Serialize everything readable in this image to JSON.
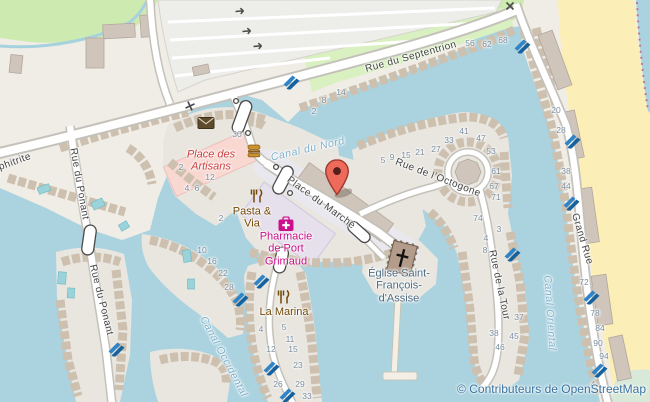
{
  "attribution": {
    "text": "© Contributeurs de OpenStreetMap"
  },
  "marker": {
    "label": "Place du Marché",
    "x": 337,
    "y": 197
  },
  "colors": {
    "water": "#abd3df",
    "land": "#f0ede6",
    "island": "#e9e6e0",
    "beach": "#fbeeb7",
    "park": "#cdebb0",
    "parking": "#ededea",
    "casing": "#c4c1ba",
    "road": "#ffffff",
    "buildingLine": "#cdc0af",
    "bigBuilding": "#cfc5bb",
    "retailPink": "#fad8d2",
    "plazaLavender": "#e6e0ec",
    "pier": "#f3efe4",
    "pool": "#9ad4da",
    "slipway": "#1f6fb3",
    "markerRed": "#ee6a5a",
    "streetText": "#444444",
    "waterText": "#7fb0cc",
    "numberText": "#7b8fa0",
    "poiBrown": "#734a08",
    "poiMagenta": "#cc0f8a",
    "poiRed": "#cc3e3e",
    "churchText": "#4e6c80",
    "attribution": "#39739f"
  },
  "street_labels": [
    {
      "text": "Rue du Septentrion",
      "x": 411,
      "y": 57,
      "rot": -15.5
    },
    {
      "text": "Grand Rue",
      "x": 582,
      "y": 239,
      "rot": 73
    },
    {
      "text": "Rue du Ponant",
      "x": 79,
      "y": 184,
      "rot": 80
    },
    {
      "text": "Rue du Ponant",
      "x": 101,
      "y": 300,
      "rot": 76
    },
    {
      "text": "Rue de l’Octogone",
      "x": 438,
      "y": 178,
      "rot": 21
    },
    {
      "text": "Rue de la Tour",
      "x": 499,
      "y": 285,
      "rot": 78
    },
    {
      "text": "Place du Marché",
      "x": 321,
      "y": 203,
      "rot": 36
    },
    {
      "text": "phitrite",
      "x": 15,
      "y": 162,
      "rot": -20
    }
  ],
  "water_labels": [
    {
      "text": "Canal du Nord",
      "x": 308,
      "y": 150,
      "rot": -13
    },
    {
      "text": "Canal Occidental",
      "x": 223,
      "y": 357,
      "rot": 62
    },
    {
      "text": "Canal Oriental",
      "x": 549,
      "y": 313,
      "rot": 86
    }
  ],
  "poi_labels": [
    {
      "text": "Place des\nArtisans",
      "x": 211,
      "y": 161,
      "rot": 0,
      "color": "#cc3e3e",
      "italic": true
    },
    {
      "text": "Pasta &\nVia",
      "x": 252,
      "y": 218,
      "color": "#734a08"
    },
    {
      "text": "Pharmacie\nde Port\nGrimaud",
      "x": 286,
      "y": 249,
      "color": "#cc0f8a"
    },
    {
      "text": "La Marina",
      "x": 284,
      "y": 312,
      "color": "#734a08"
    },
    {
      "text": "Église Saint-\nFrançois-\nd'Assise",
      "x": 399,
      "y": 286,
      "color": "#4e6c80"
    }
  ],
  "house_numbers": [
    {
      "t": "2",
      "x": 314,
      "y": 112
    },
    {
      "t": "8",
      "x": 324,
      "y": 101
    },
    {
      "t": "14",
      "x": 341,
      "y": 93
    },
    {
      "t": "56",
      "x": 470,
      "y": 44
    },
    {
      "t": "62",
      "x": 487,
      "y": 45
    },
    {
      "t": "68",
      "x": 503,
      "y": 41
    },
    {
      "t": "30",
      "x": 237,
      "y": 135
    },
    {
      "t": "2",
      "x": 181,
      "y": 168
    },
    {
      "t": "12",
      "x": 210,
      "y": 178
    },
    {
      "t": "4",
      "x": 187,
      "y": 189
    },
    {
      "t": "6",
      "x": 197,
      "y": 189
    },
    {
      "t": "5",
      "x": 383,
      "y": 161
    },
    {
      "t": "9",
      "x": 392,
      "y": 158
    },
    {
      "t": "15",
      "x": 406,
      "y": 156
    },
    {
      "t": "21",
      "x": 420,
      "y": 153
    },
    {
      "t": "27",
      "x": 436,
      "y": 150
    },
    {
      "t": "33",
      "x": 449,
      "y": 141
    },
    {
      "t": "41",
      "x": 464,
      "y": 132
    },
    {
      "t": "47",
      "x": 481,
      "y": 139
    },
    {
      "t": "53",
      "x": 491,
      "y": 152
    },
    {
      "t": "61",
      "x": 496,
      "y": 172
    },
    {
      "t": "67",
      "x": 494,
      "y": 187
    },
    {
      "t": "71",
      "x": 496,
      "y": 198
    },
    {
      "t": "74",
      "x": 478,
      "y": 219
    },
    {
      "t": "3",
      "x": 499,
      "y": 230
    },
    {
      "t": "4",
      "x": 486,
      "y": 239
    },
    {
      "t": "8",
      "x": 485,
      "y": 251
    },
    {
      "t": "20",
      "x": 556,
      "y": 111
    },
    {
      "t": "28",
      "x": 561,
      "y": 131
    },
    {
      "t": "38",
      "x": 566,
      "y": 172
    },
    {
      "t": "44",
      "x": 566,
      "y": 187
    },
    {
      "t": "72",
      "x": 584,
      "y": 283
    },
    {
      "t": "78",
      "x": 595,
      "y": 314
    },
    {
      "t": "84",
      "x": 600,
      "y": 329
    },
    {
      "t": "90",
      "x": 598,
      "y": 344
    },
    {
      "t": "94",
      "x": 604,
      "y": 357
    },
    {
      "t": "4",
      "x": 593,
      "y": 385
    },
    {
      "t": "37",
      "x": 519,
      "y": 318
    },
    {
      "t": "38",
      "x": 494,
      "y": 334
    },
    {
      "t": "45",
      "x": 514,
      "y": 337
    },
    {
      "t": "46",
      "x": 500,
      "y": 348
    },
    {
      "t": "10",
      "x": 202,
      "y": 251
    },
    {
      "t": "16",
      "x": 212,
      "y": 262
    },
    {
      "t": "22",
      "x": 223,
      "y": 274
    },
    {
      "t": "28",
      "x": 229,
      "y": 288
    },
    {
      "t": "2",
      "x": 221,
      "y": 219
    },
    {
      "t": "4",
      "x": 261,
      "y": 330
    },
    {
      "t": "5",
      "x": 284,
      "y": 328
    },
    {
      "t": "11",
      "x": 290,
      "y": 340
    },
    {
      "t": "12",
      "x": 271,
      "y": 350
    },
    {
      "t": "15",
      "x": 293,
      "y": 350
    },
    {
      "t": "23",
      "x": 298,
      "y": 366
    },
    {
      "t": "26",
      "x": 278,
      "y": 385
    },
    {
      "t": "29",
      "x": 300,
      "y": 385
    },
    {
      "t": "33",
      "x": 307,
      "y": 397
    }
  ],
  "icons": [
    {
      "type": "post-icon",
      "x": 206,
      "y": 123
    },
    {
      "type": "fast-food-icon",
      "x": 254,
      "y": 151
    },
    {
      "type": "restaurant-icon",
      "x": 256,
      "y": 196
    },
    {
      "type": "restaurant-icon",
      "x": 283,
      "y": 297
    },
    {
      "type": "pharmacy-icon",
      "x": 286,
      "y": 224
    },
    {
      "type": "slipway-icon",
      "x": 292,
      "y": 82
    },
    {
      "type": "slipway-icon",
      "x": 523,
      "y": 46
    },
    {
      "type": "slipway-icon",
      "x": 262,
      "y": 281
    },
    {
      "type": "slipway-icon",
      "x": 241,
      "y": 299
    },
    {
      "type": "slipway-icon",
      "x": 272,
      "y": 368
    },
    {
      "type": "slipway-icon",
      "x": 288,
      "y": 395
    },
    {
      "type": "slipway-icon",
      "x": 573,
      "y": 141
    },
    {
      "type": "slipway-icon",
      "x": 572,
      "y": 203
    },
    {
      "type": "slipway-icon",
      "x": 513,
      "y": 254
    },
    {
      "type": "slipway-icon",
      "x": 592,
      "y": 297
    },
    {
      "type": "slipway-icon",
      "x": 600,
      "y": 370
    },
    {
      "type": "slipway-icon",
      "x": 117,
      "y": 349
    },
    {
      "type": "gate-icon",
      "x": 190,
      "y": 106,
      "rot": 20
    },
    {
      "type": "gate-icon",
      "x": 510,
      "y": 6
    },
    {
      "type": "one-way-arrow-icon",
      "x": 241,
      "y": 11,
      "rot": -5
    },
    {
      "type": "one-way-arrow-icon",
      "x": 248,
      "y": 31,
      "rot": -5
    },
    {
      "type": "one-way-arrow-icon",
      "x": 259,
      "y": 46,
      "rot": -5
    }
  ]
}
